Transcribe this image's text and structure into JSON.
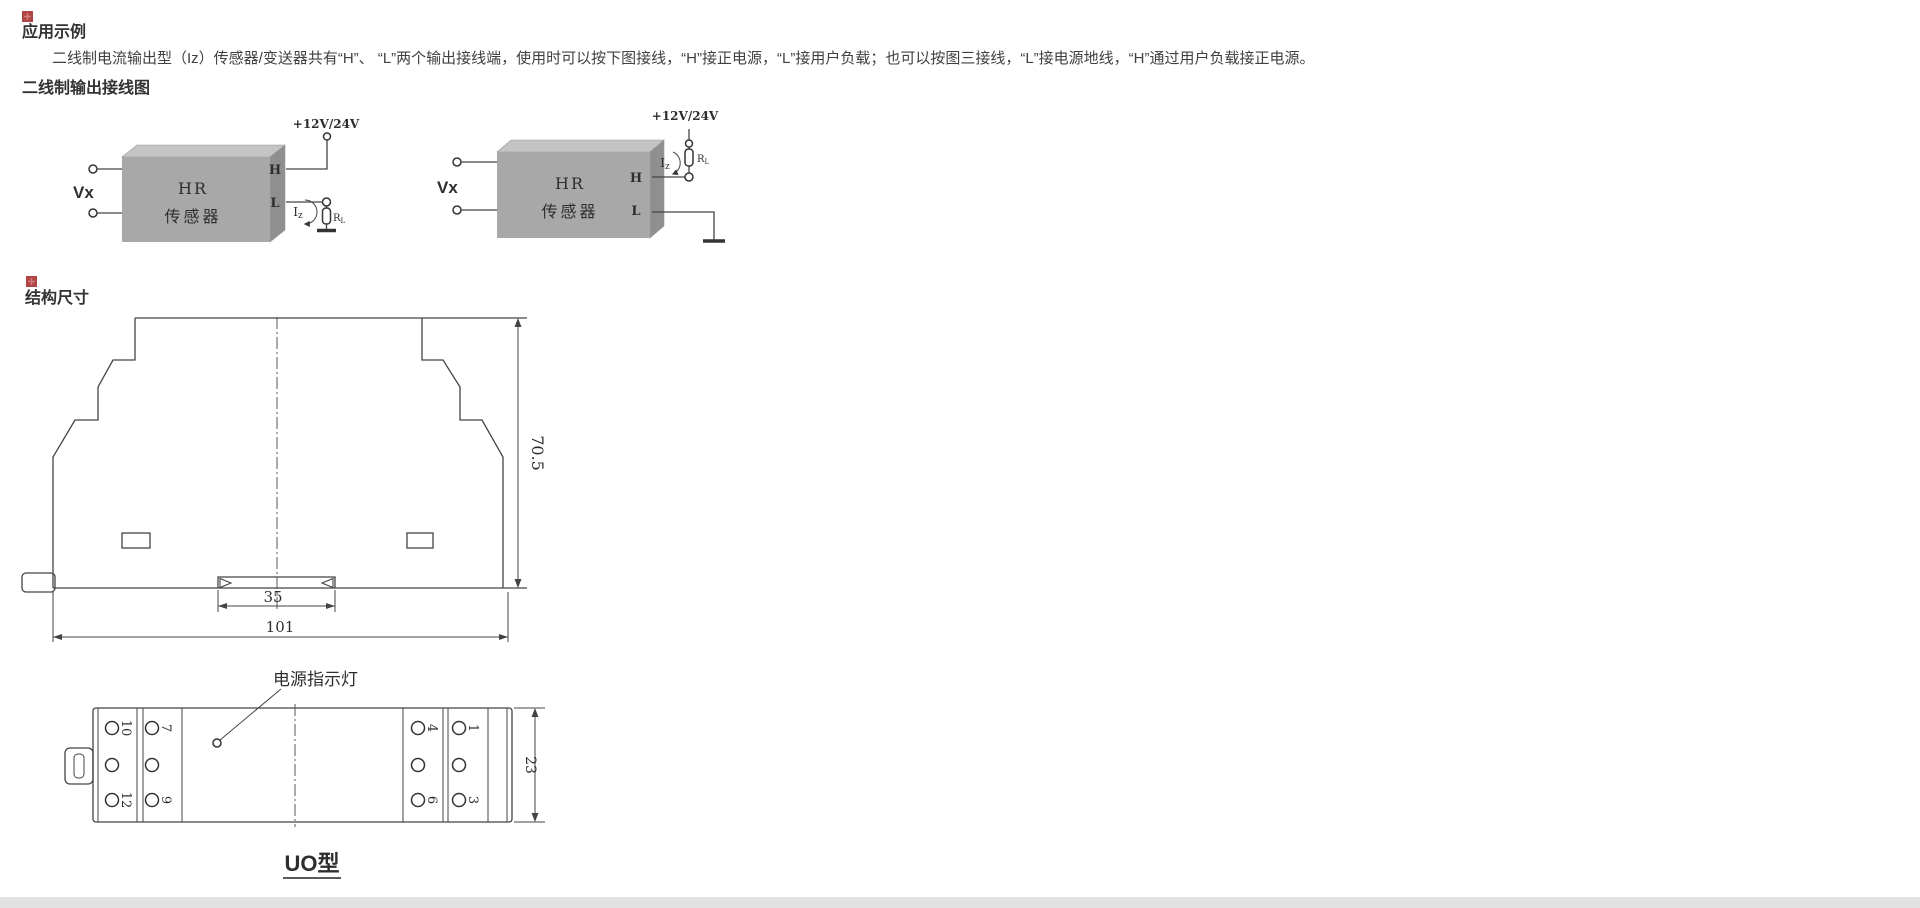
{
  "application_section": {
    "title": "应用示例",
    "body": "二线制电流输出型（Iz）传感器/变送器共有“H”、 “L”两个输出接线端，使用时可以按下图接线，“H”接正电源，“L”接用户负载；也可以按图三接线，“L”接电源地线，“H”通过用户负载接正电源。",
    "wiring_heading": "二线制输出接线图"
  },
  "structure_section": {
    "title": "结构尺寸"
  },
  "wiring": {
    "supply_label": "+12V/24V",
    "input_label": "Vx",
    "device_line1": "HR",
    "device_line2": "传感器",
    "terminal_high": "H",
    "terminal_low": "L",
    "current_symbol_main": "I",
    "current_symbol_sub": "z",
    "load_symbol_main": "R",
    "load_symbol_sub": "L"
  },
  "dimensions": {
    "height": "70.5",
    "rail_width": "35",
    "total_width": "101",
    "depth": "23"
  },
  "bottom_view": {
    "led_label": "电源指示灯",
    "model_label": "UO型",
    "terminals": {
      "t10": "10",
      "t12": "12",
      "t7": "7",
      "t9": "9",
      "t4": "4",
      "t6": "6",
      "t1": "1",
      "t3": "3"
    }
  },
  "colors": {
    "marker_red": "#b04543",
    "box_front": "#a8a8a8",
    "box_top": "#c4c4c4",
    "box_side": "#8f8f8f",
    "line": "#444444",
    "footer_bar": "#e2e2e2"
  }
}
